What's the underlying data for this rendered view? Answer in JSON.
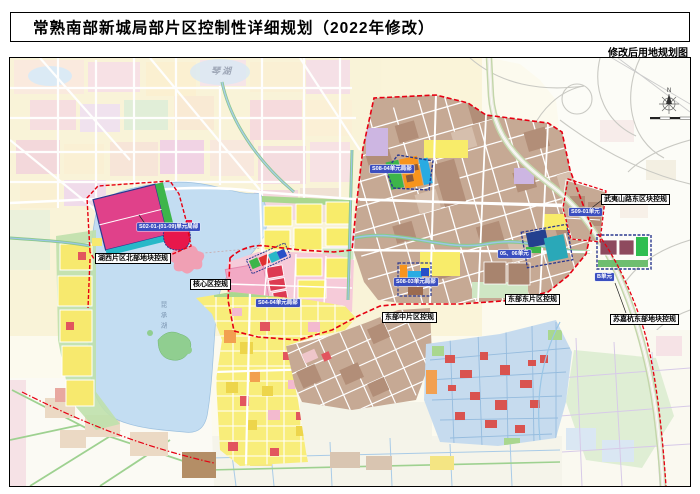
{
  "header": {
    "title": "常熟南部新城局部片区控制性详细规划（2022年修改）"
  },
  "map": {
    "type_label": "修改后用地规划图",
    "compass_n": "N",
    "places": {
      "qinhu": "琴湖",
      "kunchenghu": "昆承湖"
    },
    "plan_labels": {
      "huxi": "湖西片区北部地块控规",
      "hexin": "核心区控规",
      "dongbu_zhong": "东部中片区控规",
      "dongbu_dong": "东部东片区控规",
      "wuyishan": "武夷山路东区块控规",
      "sujiahang": "苏嘉杭东部地块控规"
    },
    "unit_labels": {
      "s02": "S02-01-(01-09)单元局部",
      "s04": "S04-04单元局部",
      "s08_04": "S08-04单元局部",
      "s08_03": "S08-03单元局部",
      "u0506": "05、06单元",
      "s09": "S09-01单元",
      "b": "B单元"
    },
    "colors": {
      "boundary_red": "#E60012",
      "unit_label_blue": "#3B4FC0",
      "lake_blue": "#C3DDF2",
      "residential_yellow": "#F8EC6A",
      "industrial_tan": "#C6A994",
      "core_pink": "#F2A9C4",
      "magenta_block": "#E0418A"
    }
  }
}
